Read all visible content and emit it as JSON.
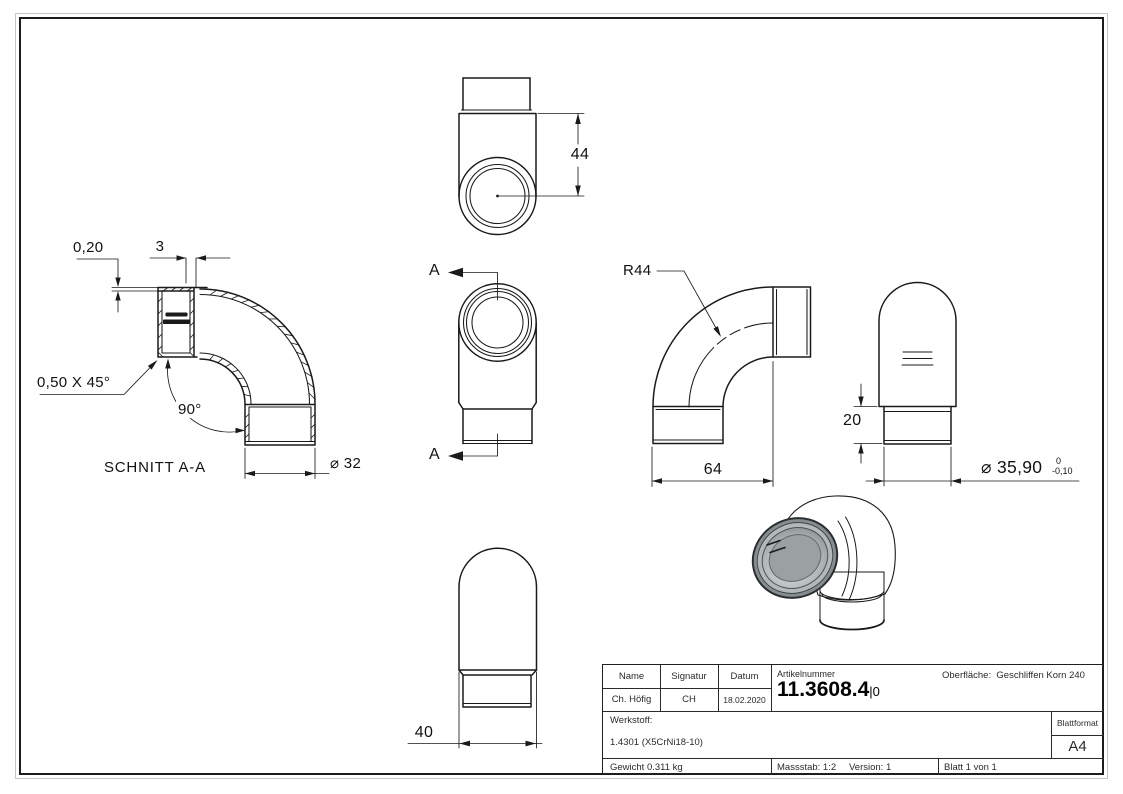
{
  "views": {
    "top": {
      "height_dim": "44"
    },
    "front": {
      "cut_top": "A",
      "cut_bottom": "A"
    },
    "section": {
      "title": "SCHNITT A-A",
      "gap_dim": "0,20",
      "wall_dim": "3",
      "chamfer_dim": "0,50 X 45°",
      "angle_dim": "90°",
      "bore_dim": "⌀ 32"
    },
    "side": {
      "radius_dim": "R44",
      "length_dim": "64"
    },
    "end": {
      "sleeve_dim": "20",
      "diameter_dim": "⌀ 35,90",
      "tol_upper": "0",
      "tol_lower": "-0,10"
    },
    "bottom": {
      "width_dim": "40"
    }
  },
  "title_block": {
    "name_header": "Name",
    "signature_header": "Signatur",
    "date_header": "Datum",
    "name": "Ch. Höfig",
    "signature": "CH",
    "date": "18.02.2020",
    "article_label": "Artikelnummer",
    "article_number": "11.3608.4",
    "article_suffix": "|0",
    "surface_label": "Oberfläche:",
    "surface_value": "Geschliffen Korn 240",
    "material_label": "Werkstoff:",
    "material_value": "1.4301 (X5CrNi18-10)",
    "format_label": "Blattformat",
    "format_value": "A4",
    "weight": "Gewicht 0.311 kg",
    "scale": "Massstab: 1:2",
    "version": "Version: 1",
    "sheet": "Blatt 1 von 1"
  },
  "colors": {
    "line": "#1a1a1a",
    "render_body": "#9a9ea0"
  }
}
